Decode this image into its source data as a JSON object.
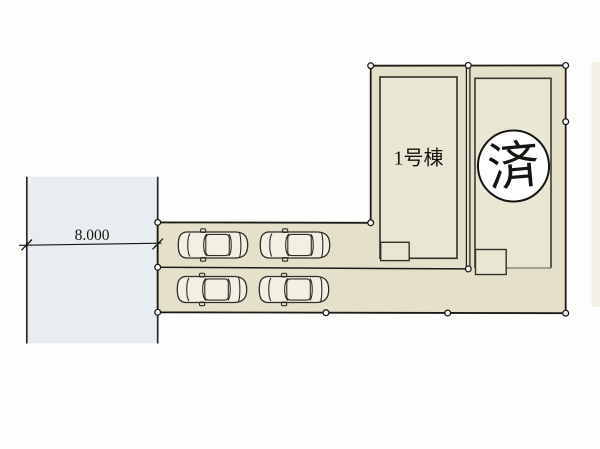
{
  "page": {
    "background": "#fdfdfb",
    "title": "site-plan"
  },
  "plan": {
    "labels": {
      "building1": "1号棟",
      "sold_stamp": "済",
      "road_width": "8.000"
    },
    "colors": {
      "lot_fill": "#e5e0c9",
      "building_fill": "#eae6d4",
      "road_fill": "#e8edf1",
      "car_fill": "#f2efe3",
      "stamp_fill": "#ffffff",
      "line": "#1c1b17",
      "edge_strip": "#eae5d2"
    }
  }
}
